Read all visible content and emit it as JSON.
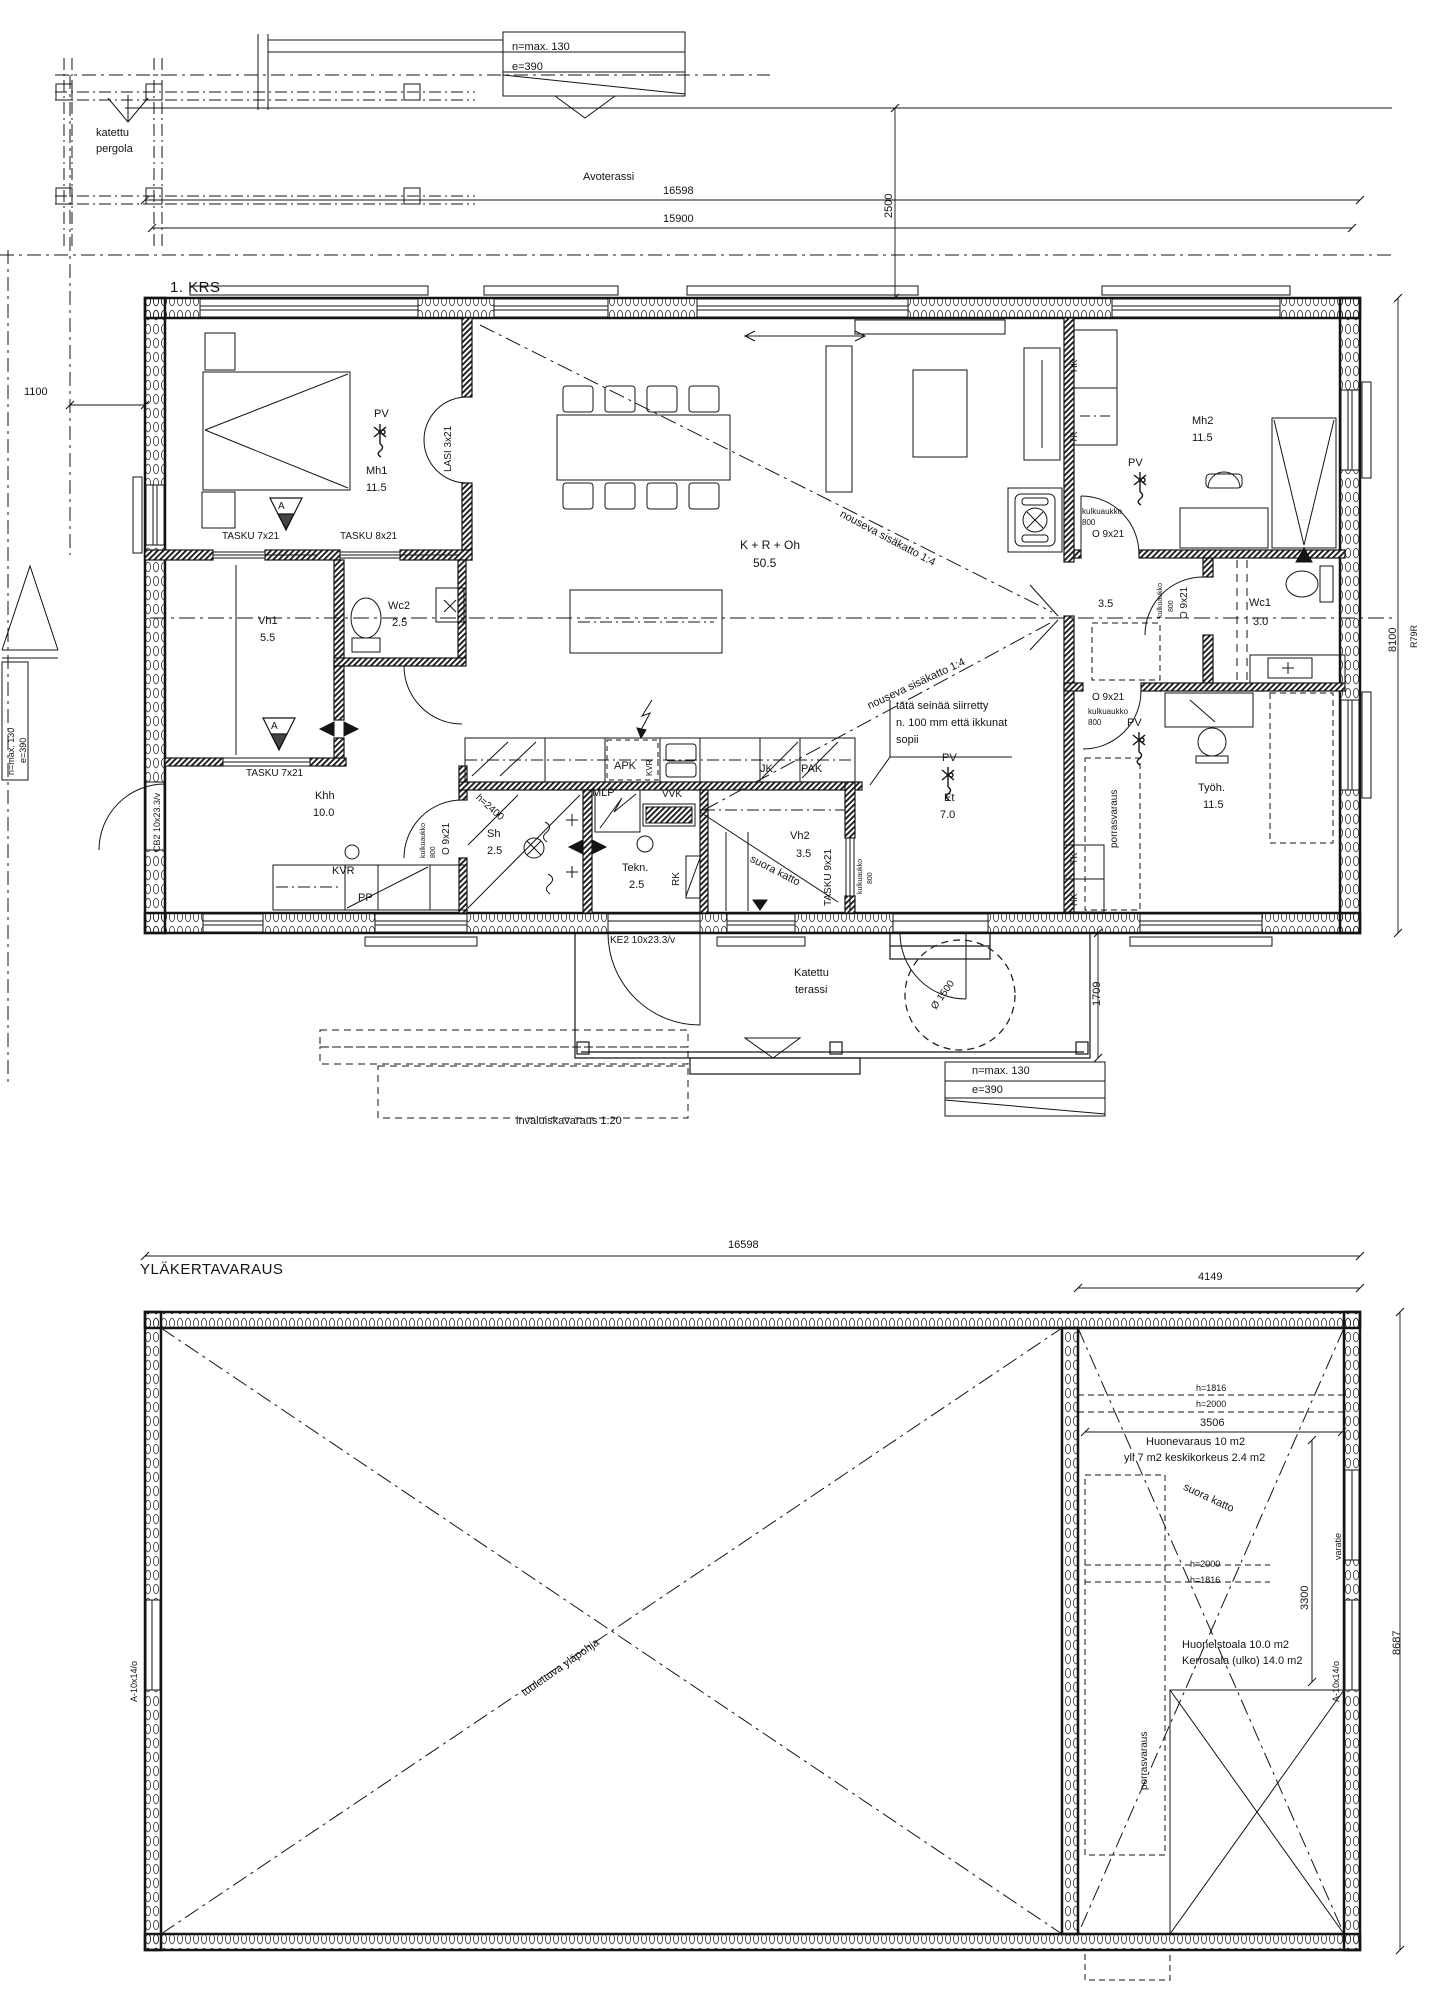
{
  "drawing": {
    "type": "floor-plan",
    "line_color": "#141414",
    "bg_color": "#ffffff"
  },
  "titles": {
    "floor1": "1. KRS",
    "floor2": "YLÄKERTAVARAUS"
  },
  "floor1_labels": [
    {
      "id": "nmax-top",
      "t": "n=max. 130",
      "x": 512,
      "y": 42,
      "fs": 11
    },
    {
      "id": "e390-top",
      "t": "e=390",
      "x": 512,
      "y": 62,
      "fs": 11
    },
    {
      "id": "katettu",
      "t": "katettu",
      "x": 96,
      "y": 128,
      "fs": 11
    },
    {
      "id": "pergola",
      "t": "pergola",
      "x": 96,
      "y": 144,
      "fs": 11
    },
    {
      "id": "avoterassi",
      "t": "Avoterassi",
      "x": 583,
      "y": 172,
      "fs": 11
    },
    {
      "id": "dim-16598-1",
      "t": "16598",
      "x": 663,
      "y": 186,
      "fs": 11
    },
    {
      "id": "dim-15900",
      "t": "15900",
      "x": 663,
      "y": 214,
      "fs": 11
    },
    {
      "id": "dim-2500",
      "t": "2500",
      "x": 884,
      "y": 218,
      "fs": 11,
      "rot": -90
    },
    {
      "id": "dim-1100",
      "t": "1100",
      "x": 24,
      "y": 387,
      "fs": 11
    },
    {
      "id": "pv-mh1",
      "t": "PV",
      "x": 374,
      "y": 409,
      "fs": 11
    },
    {
      "id": "mh1",
      "t": "Mh1",
      "x": 366,
      "y": 466,
      "fs": 11
    },
    {
      "id": "mh1-a",
      "t": "11.5",
      "x": 366,
      "y": 483,
      "fs": 11
    },
    {
      "id": "lasi",
      "t": "LASI 3x21",
      "x": 444,
      "y": 472,
      "fs": 10,
      "rot": -90
    },
    {
      "id": "sec-a1",
      "t": "A",
      "x": 278,
      "y": 502,
      "fs": 10
    },
    {
      "id": "tasku7a",
      "t": "TASKU 7x21",
      "x": 222,
      "y": 532,
      "fs": 10
    },
    {
      "id": "tasku8",
      "t": "TASKU 8x21",
      "x": 340,
      "y": 532,
      "fs": 10
    },
    {
      "id": "vh1",
      "t": "Vh1",
      "x": 258,
      "y": 616,
      "fs": 11
    },
    {
      "id": "vh1-a",
      "t": "5.5",
      "x": 260,
      "y": 633,
      "fs": 11
    },
    {
      "id": "wc2",
      "t": "Wc2",
      "x": 388,
      "y": 601,
      "fs": 11
    },
    {
      "id": "wc2-a",
      "t": "2.5",
      "x": 392,
      "y": 618,
      "fs": 11
    },
    {
      "id": "sec-a2",
      "t": "A",
      "x": 271,
      "y": 722,
      "fs": 10
    },
    {
      "id": "tasku7b",
      "t": "TASKU 7x21",
      "x": 246,
      "y": 769,
      "fs": 10
    },
    {
      "id": "khh",
      "t": "Khh",
      "x": 315,
      "y": 791,
      "fs": 11
    },
    {
      "id": "khh-a",
      "t": "10.0",
      "x": 313,
      "y": 808,
      "fs": 11
    },
    {
      "id": "cb2",
      "t": "CB2 10x23.3/v",
      "x": 153,
      "y": 852,
      "fs": 9,
      "rot": -90
    },
    {
      "id": "kulk1",
      "t": "kulkuaukko",
      "x": 420,
      "y": 858,
      "fs": 7,
      "rot": -90
    },
    {
      "id": "kulk1b",
      "t": "800",
      "x": 430,
      "y": 858,
      "fs": 7,
      "rot": -90
    },
    {
      "id": "o9-1",
      "t": "O 9x21",
      "x": 442,
      "y": 855,
      "fs": 10,
      "rot": -90
    },
    {
      "id": "kvr",
      "t": "KVR",
      "x": 332,
      "y": 866,
      "fs": 11
    },
    {
      "id": "pp",
      "t": "PP",
      "x": 358,
      "y": 893,
      "fs": 11
    },
    {
      "id": "h2400",
      "t": "h=2400",
      "x": 480,
      "y": 793,
      "fs": 10,
      "rot": 42
    },
    {
      "id": "sh",
      "t": "Sh",
      "x": 487,
      "y": 829,
      "fs": 11
    },
    {
      "id": "sh-a",
      "t": "2.5",
      "x": 487,
      "y": 846,
      "fs": 11
    },
    {
      "id": "mlp",
      "t": "MLP",
      "x": 592,
      "y": 788,
      "fs": 11
    },
    {
      "id": "apk",
      "t": "APK",
      "x": 614,
      "y": 761,
      "fs": 11
    },
    {
      "id": "kvr2",
      "t": "KVR",
      "x": 646,
      "y": 776,
      "fs": 8,
      "rot": -90
    },
    {
      "id": "jk",
      "t": "JK",
      "x": 760,
      "y": 764,
      "fs": 11
    },
    {
      "id": "pak",
      "t": "PAK",
      "x": 801,
      "y": 764,
      "fs": 11
    },
    {
      "id": "vvk",
      "t": "VVK",
      "x": 662,
      "y": 790,
      "fs": 10
    },
    {
      "id": "tekn",
      "t": "Tekn.",
      "x": 622,
      "y": 863,
      "fs": 11
    },
    {
      "id": "tekn-a",
      "t": "2.5",
      "x": 629,
      "y": 880,
      "fs": 11
    },
    {
      "id": "rk",
      "t": "RK",
      "x": 672,
      "y": 886,
      "fs": 10,
      "rot": -90
    },
    {
      "id": "kroh",
      "t": "K + R + Oh",
      "x": 740,
      "y": 539,
      "fs": 12
    },
    {
      "id": "kroh-a",
      "t": "50.5",
      "x": 753,
      "y": 557,
      "fs": 12
    },
    {
      "id": "nous1",
      "t": "nouseva sisäkatto 1:4",
      "x": 843,
      "y": 509,
      "fs": 11,
      "rot": 28
    },
    {
      "id": "nous2",
      "t": "nouseva sisäkatto 1:4",
      "x": 866,
      "y": 702,
      "fs": 11,
      "rot": -25
    },
    {
      "id": "note1",
      "t": "tätä seinää siirretty",
      "x": 896,
      "y": 701,
      "fs": 11
    },
    {
      "id": "note2",
      "t": "n. 100 mm että ikkunat",
      "x": 896,
      "y": 718,
      "fs": 11
    },
    {
      "id": "note3",
      "t": "sopii",
      "x": 896,
      "y": 735,
      "fs": 11
    },
    {
      "id": "pv-et",
      "t": "PV",
      "x": 942,
      "y": 753,
      "fs": 11
    },
    {
      "id": "et",
      "t": "Et",
      "x": 944,
      "y": 793,
      "fs": 11
    },
    {
      "id": "et-a",
      "t": "7.0",
      "x": 940,
      "y": 810,
      "fs": 11
    },
    {
      "id": "vh2",
      "t": "Vh2",
      "x": 790,
      "y": 831,
      "fs": 11
    },
    {
      "id": "vh2-a",
      "t": "3.5",
      "x": 796,
      "y": 849,
      "fs": 11
    },
    {
      "id": "tasku9",
      "t": "TASKU 9x21",
      "x": 824,
      "y": 906,
      "fs": 10,
      "rot": -90
    },
    {
      "id": "kulk2",
      "t": "kulkuaukko",
      "x": 857,
      "y": 894,
      "fs": 7,
      "rot": -90
    },
    {
      "id": "kulk2b",
      "t": "800",
      "x": 867,
      "y": 884,
      "fs": 7,
      "rot": -90
    },
    {
      "id": "suora1",
      "t": "suora katto",
      "x": 753,
      "y": 854,
      "fs": 11,
      "rot": 27
    },
    {
      "id": "ke2",
      "t": "KE2 10x23.3/v",
      "x": 610,
      "y": 936,
      "fs": 10
    },
    {
      "id": "katettu-t",
      "t": "Katettu",
      "x": 794,
      "y": 968,
      "fs": 11
    },
    {
      "id": "terassi",
      "t": "terassi",
      "x": 795,
      "y": 985,
      "fs": 11
    },
    {
      "id": "o1500",
      "t": "Ø 1500",
      "x": 930,
      "y": 1006,
      "fs": 10,
      "rot": -55
    },
    {
      "id": "dim-1709",
      "t": "1709",
      "x": 1092,
      "y": 1006,
      "fs": 11,
      "rot": -90
    },
    {
      "id": "nmax-bot",
      "t": "n=max. 130",
      "x": 972,
      "y": 1066,
      "fs": 11
    },
    {
      "id": "e390-bot",
      "t": "e=390",
      "x": 972,
      "y": 1085,
      "fs": 11
    },
    {
      "id": "invaluiska",
      "t": "invaluiskavaraus 1:20",
      "x": 516,
      "y": 1116,
      "fs": 11
    },
    {
      "id": "mh2",
      "t": "Mh2",
      "x": 1192,
      "y": 416,
      "fs": 11
    },
    {
      "id": "mh2-a",
      "t": "11.5",
      "x": 1192,
      "y": 433,
      "fs": 11
    },
    {
      "id": "pv-mh2",
      "t": "PV",
      "x": 1128,
      "y": 458,
      "fs": 11
    },
    {
      "id": "kulk3",
      "t": "kulkuaukko",
      "x": 1082,
      "y": 508,
      "fs": 8
    },
    {
      "id": "kulk3b",
      "t": "800",
      "x": 1082,
      "y": 519,
      "fs": 8
    },
    {
      "id": "o9-2",
      "t": "O 9x21",
      "x": 1092,
      "y": 530,
      "fs": 10
    },
    {
      "id": "hk1",
      "t": "HK",
      "x": 1070,
      "y": 372,
      "fs": 9,
      "rot": -90
    },
    {
      "id": "tk1",
      "t": "TK",
      "x": 1070,
      "y": 443,
      "fs": 9,
      "rot": -90
    },
    {
      "id": "hall35",
      "t": "3.5",
      "x": 1098,
      "y": 599,
      "fs": 11
    },
    {
      "id": "kulk4",
      "t": "kulkuaukko",
      "x": 1157,
      "y": 618,
      "fs": 7,
      "rot": -90
    },
    {
      "id": "kulk4b",
      "t": "800",
      "x": 1168,
      "y": 612,
      "fs": 7,
      "rot": -90
    },
    {
      "id": "o9-3",
      "t": "O 9x21",
      "x": 1180,
      "y": 619,
      "fs": 10,
      "rot": -90
    },
    {
      "id": "wc1",
      "t": "Wc1",
      "x": 1249,
      "y": 598,
      "fs": 11
    },
    {
      "id": "wc1-a",
      "t": "3.0",
      "x": 1253,
      "y": 617,
      "fs": 11
    },
    {
      "id": "o9-4",
      "t": "O 9x21",
      "x": 1092,
      "y": 693,
      "fs": 10
    },
    {
      "id": "kulk5",
      "t": "kulkuaukko",
      "x": 1088,
      "y": 708,
      "fs": 8
    },
    {
      "id": "kulk5b",
      "t": "800",
      "x": 1088,
      "y": 719,
      "fs": 8
    },
    {
      "id": "pv-tyo",
      "t": "PV",
      "x": 1127,
      "y": 718,
      "fs": 11
    },
    {
      "id": "tyoh",
      "t": "Työh.",
      "x": 1198,
      "y": 783,
      "fs": 11
    },
    {
      "id": "tyoh-a",
      "t": "11.5",
      "x": 1203,
      "y": 800,
      "fs": 11
    },
    {
      "id": "porras1",
      "t": "porrasvaraus",
      "x": 1110,
      "y": 848,
      "fs": 10,
      "rot": -90
    },
    {
      "id": "tk2",
      "t": "TK",
      "x": 1070,
      "y": 864,
      "fs": 9,
      "rot": -90
    },
    {
      "id": "hk2",
      "t": "HK",
      "x": 1070,
      "y": 906,
      "fs": 9,
      "rot": -90
    },
    {
      "id": "dim-8100",
      "t": "8100",
      "x": 1388,
      "y": 652,
      "fs": 11,
      "rot": -90
    },
    {
      "id": "r79r",
      "t": "R79R",
      "x": 1410,
      "y": 648,
      "fs": 9,
      "rot": -90
    },
    {
      "id": "nmax-left",
      "t": "n=max. 130",
      "x": 7,
      "y": 775,
      "fs": 9,
      "rot": -90
    },
    {
      "id": "e390-left",
      "t": "e=390",
      "x": 19,
      "y": 763,
      "fs": 9,
      "rot": -90
    }
  ],
  "floor2_labels": [
    {
      "id": "dim-16598-2",
      "t": "16598",
      "x": 728,
      "y": 1240,
      "fs": 11
    },
    {
      "id": "dim-4149",
      "t": "4149",
      "x": 1198,
      "y": 1272,
      "fs": 11
    },
    {
      "id": "a10-left",
      "t": "A-10x14/o",
      "x": 130,
      "y": 1702,
      "fs": 9,
      "rot": -90
    },
    {
      "id": "a10-right",
      "t": "A-10x14/o",
      "x": 1332,
      "y": 1702,
      "fs": 9,
      "rot": -90
    },
    {
      "id": "dim-8687",
      "t": "8687",
      "x": 1392,
      "y": 1655,
      "fs": 11,
      "rot": -90
    },
    {
      "id": "h1816-a",
      "t": "h=1816",
      "x": 1196,
      "y": 1384,
      "fs": 9
    },
    {
      "id": "h2000-a",
      "t": "h=2000",
      "x": 1196,
      "y": 1400,
      "fs": 9
    },
    {
      "id": "dim-3506",
      "t": "3506",
      "x": 1200,
      "y": 1418,
      "fs": 11
    },
    {
      "id": "huonevaraus",
      "t": "Huonevaraus 10 m2",
      "x": 1146,
      "y": 1437,
      "fs": 11
    },
    {
      "id": "yli7",
      "t": "yli 7 m2 keskikorkeus 2.4 m2",
      "x": 1124,
      "y": 1453,
      "fs": 11
    },
    {
      "id": "suora2",
      "t": "suora katto",
      "x": 1186,
      "y": 1482,
      "fs": 11,
      "rot": 25
    },
    {
      "id": "dim-3300",
      "t": "3300",
      "x": 1300,
      "y": 1610,
      "fs": 11,
      "rot": -90
    },
    {
      "id": "varatie",
      "t": "varatie",
      "x": 1334,
      "y": 1560,
      "fs": 9,
      "rot": -90
    },
    {
      "id": "h2000-b",
      "t": "h=2000",
      "x": 1190,
      "y": 1560,
      "fs": 9
    },
    {
      "id": "h1816-b",
      "t": "h=1816",
      "x": 1190,
      "y": 1576,
      "fs": 9
    },
    {
      "id": "huoneistoala",
      "t": "Huoneistoala 10.0 m2",
      "x": 1182,
      "y": 1640,
      "fs": 11
    },
    {
      "id": "kerrosala",
      "t": "Kerrosala (ulko) 14.0 m2",
      "x": 1182,
      "y": 1656,
      "fs": 11
    },
    {
      "id": "porras2",
      "t": "porrasvaraus",
      "x": 1140,
      "y": 1790,
      "fs": 10,
      "rot": -90
    },
    {
      "id": "tuulettuva",
      "t": "tuulettuva yläpohja",
      "x": 520,
      "y": 1690,
      "fs": 11,
      "rot": -35
    }
  ]
}
